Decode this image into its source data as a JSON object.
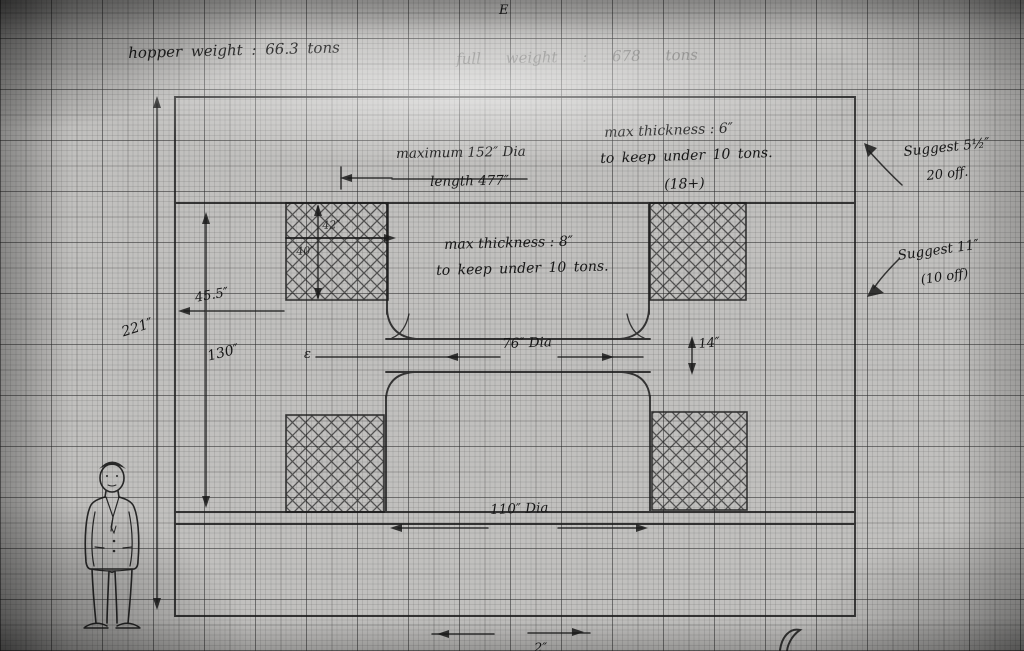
{
  "drawing": {
    "sheet_mark": "E",
    "centerline_mark": "ε",
    "header": {
      "hopper_weight": "hopper weight : 66.3 tons",
      "total_weight": "full weight : 678 tons"
    },
    "notes": {
      "bore_line1": "maximum 152″ Dia",
      "bore_line2": "length 477″",
      "upper_wall_line1": "max thickness : 6″",
      "upper_wall_line2": "to keep under 10 tons.",
      "upper_wall_line3": "(18+)",
      "mid_wall_line1": "max thickness : 8″",
      "mid_wall_line2": "to keep under 10 tons.",
      "suggest_upper_line1": "Suggest 5½″",
      "suggest_upper_line2": "20 off.",
      "suggest_lower_line1": "Suggest 11″",
      "suggest_lower_line2": "(10 off)"
    },
    "dimensions": {
      "overall_height": "221″",
      "inner_height": "130″",
      "wall_offset": "45.5″",
      "waist_diameter": "76″ Dia",
      "waist_band_height": "14″",
      "base_diameter": "110″ Dia",
      "hatch_upper": "42″",
      "hatch_lower": "40″",
      "bottom_partial": "2″"
    }
  }
}
